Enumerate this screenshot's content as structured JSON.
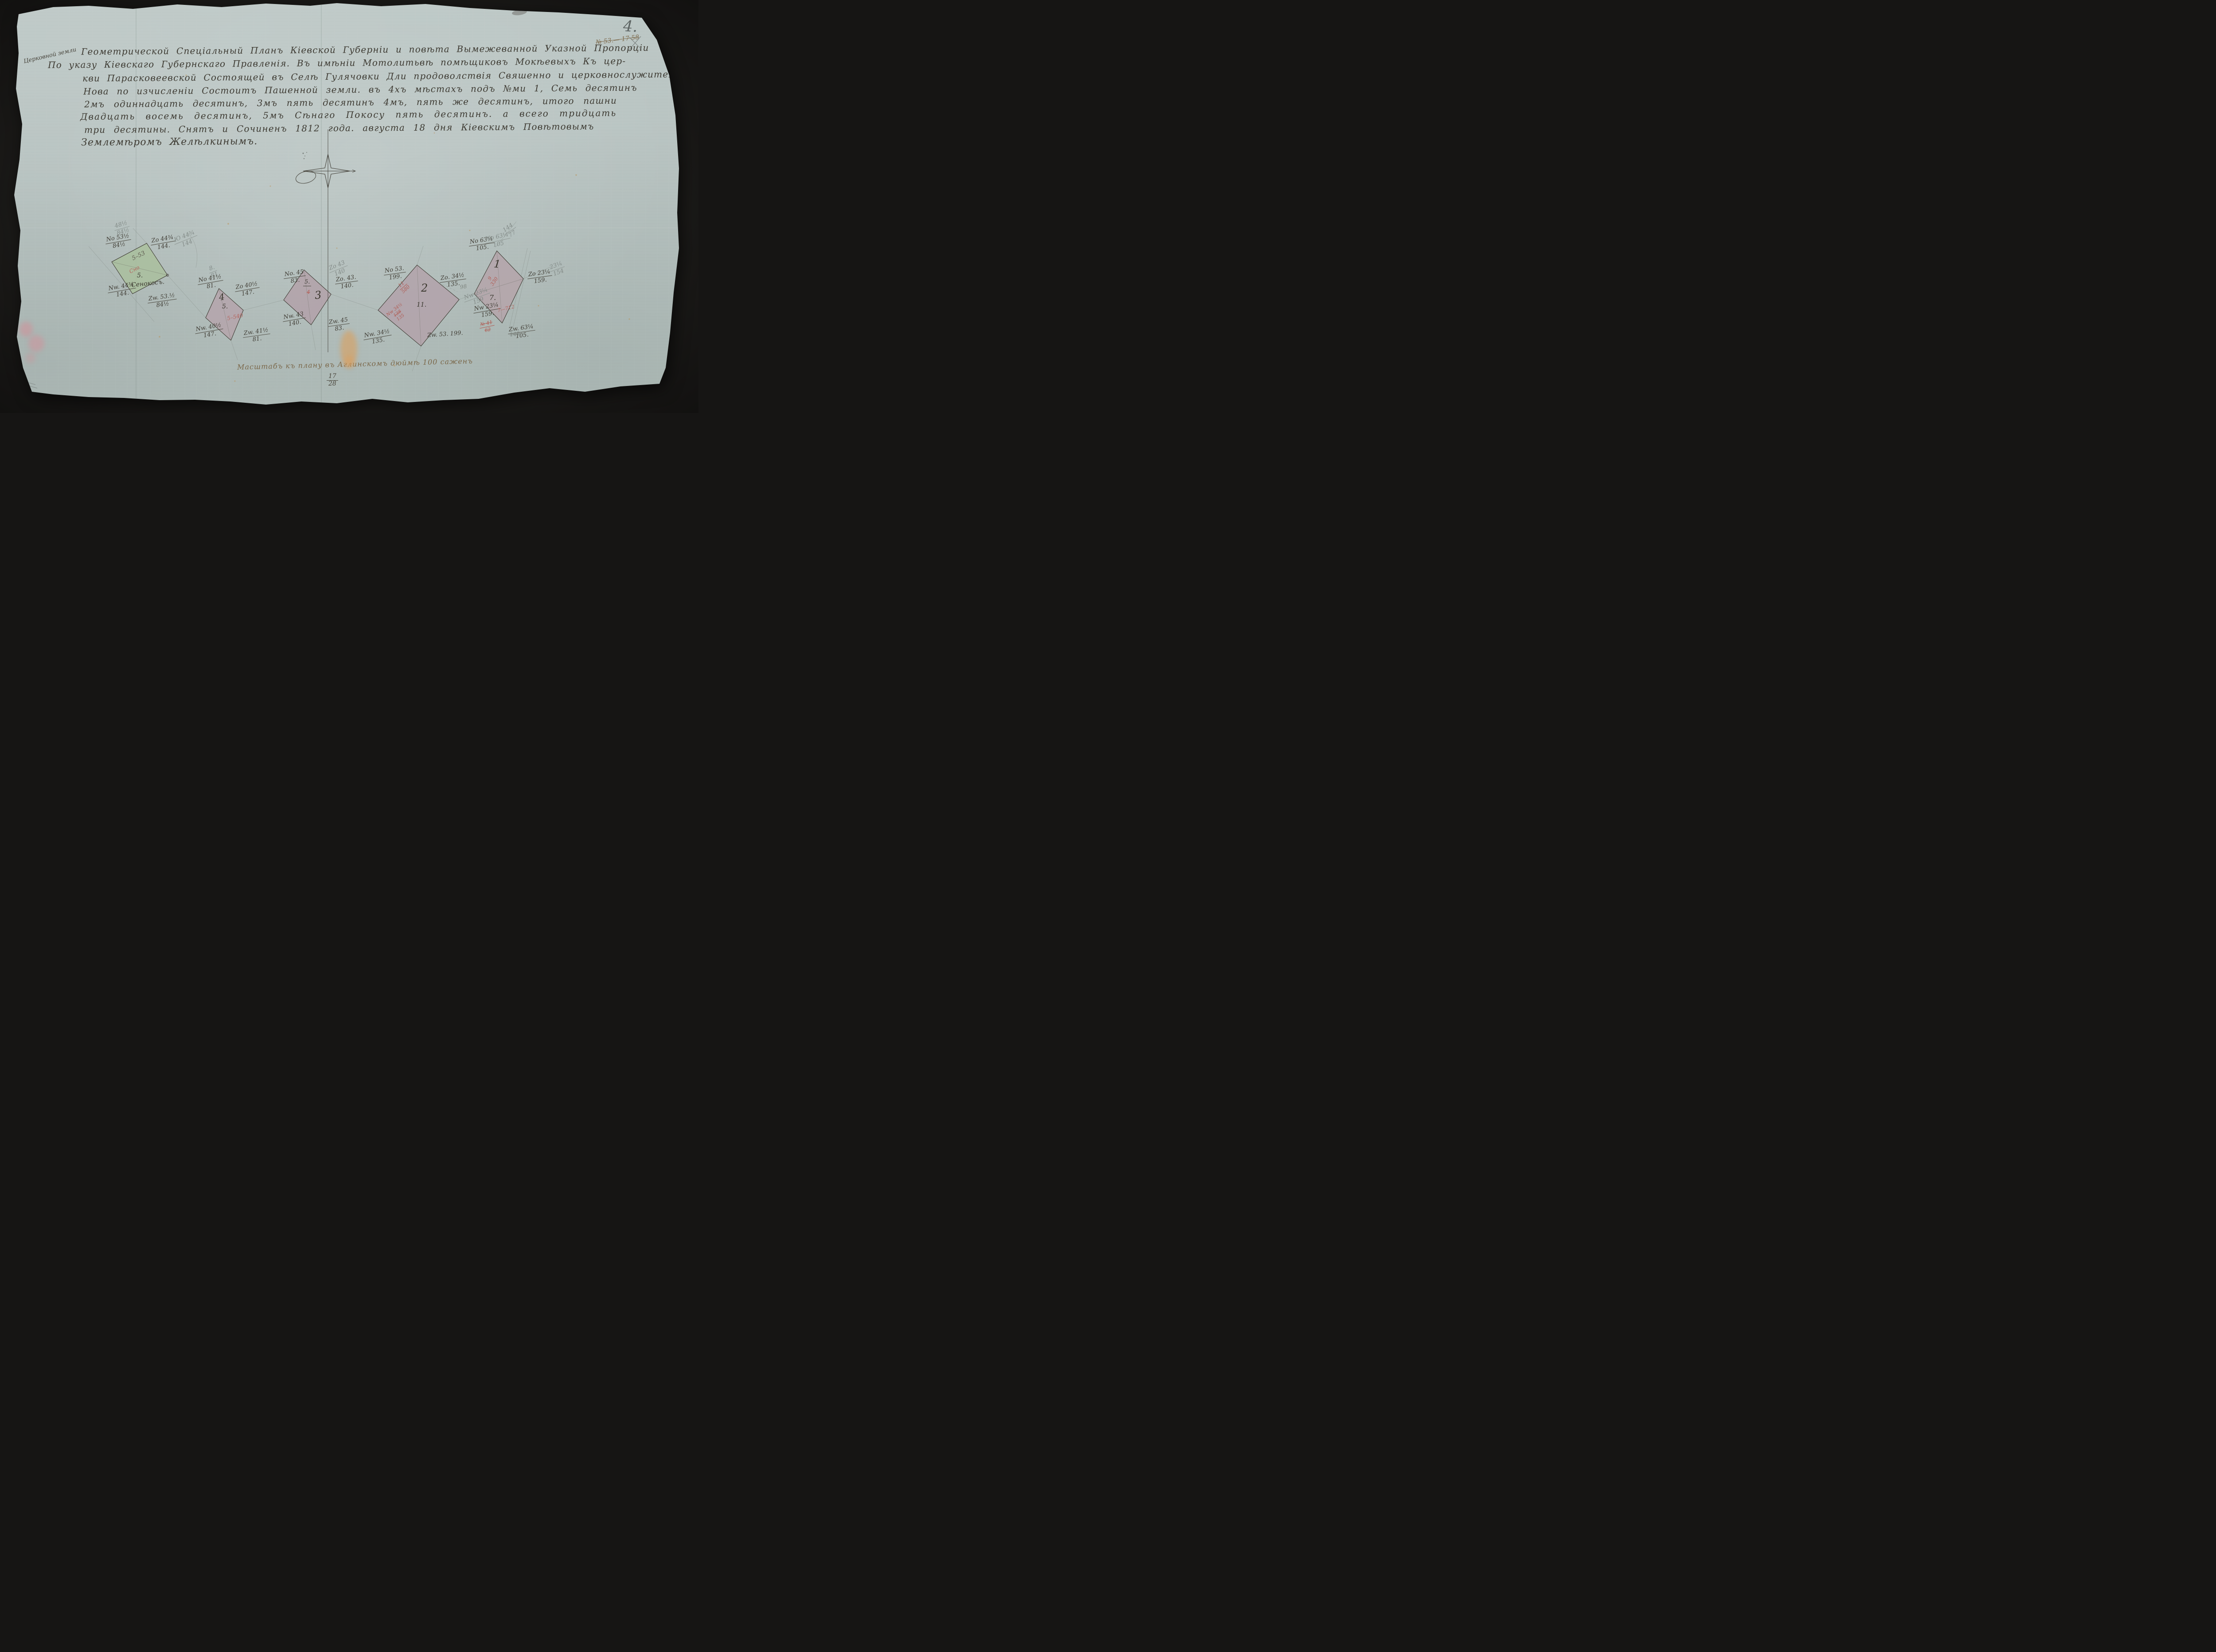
{
  "palette": {
    "paper": "#b8c3c1",
    "background": "#1c1b19",
    "ink": "#3e3b33",
    "faded_ink": "#7b684a",
    "pencil": "#838b88",
    "red_ink": "#b4635c",
    "parcel_green": "#a9bf9c",
    "parcel_pink": "#b3a2a9"
  },
  "marks": {
    "page_number": "4.",
    "crossed_archive_note": "№ 53.— 17 58",
    "left_edge_note": "3."
  },
  "header": {
    "marginal_note": "Церковной земли",
    "lines": [
      "Геометрической Спеціальный Планъ Кіевской Губерніи и повѣта Вымежеванной Указной Пропорціи",
      "По указу Кіевскаго Губернскаго Правленія. Въ имѣніи Мотолитьвѣ помѣщиковъ Мокѣевыхъ Къ цер-",
      "кви Парасковеевской Состоящей въ Селѣ Гулячовки Дли продоволствія Свяшенно и церковнослужителей",
      "Нова по изчисленіи Состоитъ Пашенной земли. въ 4хъ мѣстахъ подъ №ми 1, Семь десятинъ",
      "2мъ одиннадцать десятинъ, 3мъ пять десятинъ 4мъ, пять же десятинъ, итого пашни",
      "Двадцать восемь десятинъ, 5мъ Сѣнаго Покосу пять десятинъ. а всего тридцать",
      "три десятины. Снятъ и Сочиненъ 1812 года. августа 18 дня Кіевскимъ Повѣтовымъ",
      "Землемѣромъ Желѣлкинымъ."
    ]
  },
  "parcels": [
    {
      "number": "5",
      "color": "#a9bf9c",
      "inner": {
        "area_note": "5–53",
        "red_word": "Сно",
        "number_small": "5.",
        "land_use": "Сенокосъ."
      },
      "labels": {
        "no": {
          "dir": "No 53½",
          "val": "84½"
        },
        "zo": {
          "dir": "Zо 44¾",
          "val": "144."
        },
        "nw": {
          "dir": "Nw. 44¾",
          "val": "144."
        },
        "zw": {
          "dir": "Zw. 53.½",
          "val": "84½"
        }
      },
      "pencil": {
        "top": {
          "dir": "48½",
          "val": "84½"
        },
        "zo": {
          "dir": "Ю 44¾",
          "val": "144"
        }
      }
    },
    {
      "number": "4",
      "color": "#b5a4ab",
      "inner": {
        "big": "4",
        "number_small": "5.",
        "red_note": "5–540"
      },
      "labels": {
        "no": {
          "dir": "No 41½",
          "val": "81."
        },
        "zo": {
          "dir": "Zо 40½",
          "val": "147."
        },
        "nw": {
          "dir": "Nw. 40½",
          "val": "147."
        },
        "zw": {
          "dir": "Zw. 41½",
          "val": "81."
        }
      },
      "pencil": {
        "top": {
          "dir": "8.",
          "val": "81"
        }
      }
    },
    {
      "number": "3",
      "color": "#b2a0a8",
      "inner": {
        "big": "3",
        "number_small": "5.",
        "red_struck": "4"
      },
      "labels": {
        "no": {
          "dir": "No. 45",
          "val": "83."
        },
        "zo": {
          "dir": "Zо. 43.",
          "val": "140."
        },
        "nw": {
          "dir": "Nw. 43",
          "val": "140."
        },
        "zw": {
          "dir": "Zw. 45",
          "val": "83."
        }
      },
      "pencil": {
        "zo": {
          "dir": "Zо 43",
          "val": "140"
        }
      }
    },
    {
      "number": "2",
      "color": "#b2a1a9",
      "inner": {
        "big": "2",
        "number_small": "11.",
        "red_top": "11",
        "red_bot": "580"
      },
      "red_struck": {
        "dir": "Nw 34½",
        "old": "138",
        "val": "135"
      },
      "labels": {
        "no": {
          "dir": "No 53.",
          "val": "199."
        },
        "zo": {
          "dir": "Zо. 34½",
          "val": "135."
        },
        "nw": {
          "dir": "Nw. 34½",
          "val": "135."
        },
        "zw": {
          "dir": "Zw. 53. 199.",
          "val": ""
        }
      },
      "pencil": {
        "right_top": "98",
        "right": {
          "dir": "Nw 23¼",
          "val": "159"
        }
      }
    },
    {
      "number": "1",
      "color": "#b5a3aa",
      "inner": {
        "big": "1",
        "red_top": "9",
        "red_bot": "330",
        "number_small": "7.",
        "red_note": "7—712"
      },
      "red_struck": {
        "dir": "№ 41",
        "val": "62"
      },
      "struck_value": "140",
      "labels": {
        "no": {
          "dir": "No 63¼",
          "val": "105."
        },
        "zo": {
          "dir": "Zо 23¼",
          "val": "159."
        },
        "nw": {
          "dir": "Nw 23¼",
          "val": "159."
        },
        "zw": {
          "dir": "Zw. 63¼",
          "val": "105."
        }
      },
      "pencil": {
        "no": {
          "dir": "No 63¼",
          "val": "105"
        },
        "diag": {
          "dir": "144",
          "val": "77"
        },
        "zo": {
          "dir": "23¼",
          "val": "154"
        }
      }
    }
  ],
  "scale_bar": {
    "caption": "Масштабъ къ плану въ Аглинскомъ дюймѣ 100 саженъ",
    "fraction_top": "17",
    "fraction_bottom": "28"
  }
}
